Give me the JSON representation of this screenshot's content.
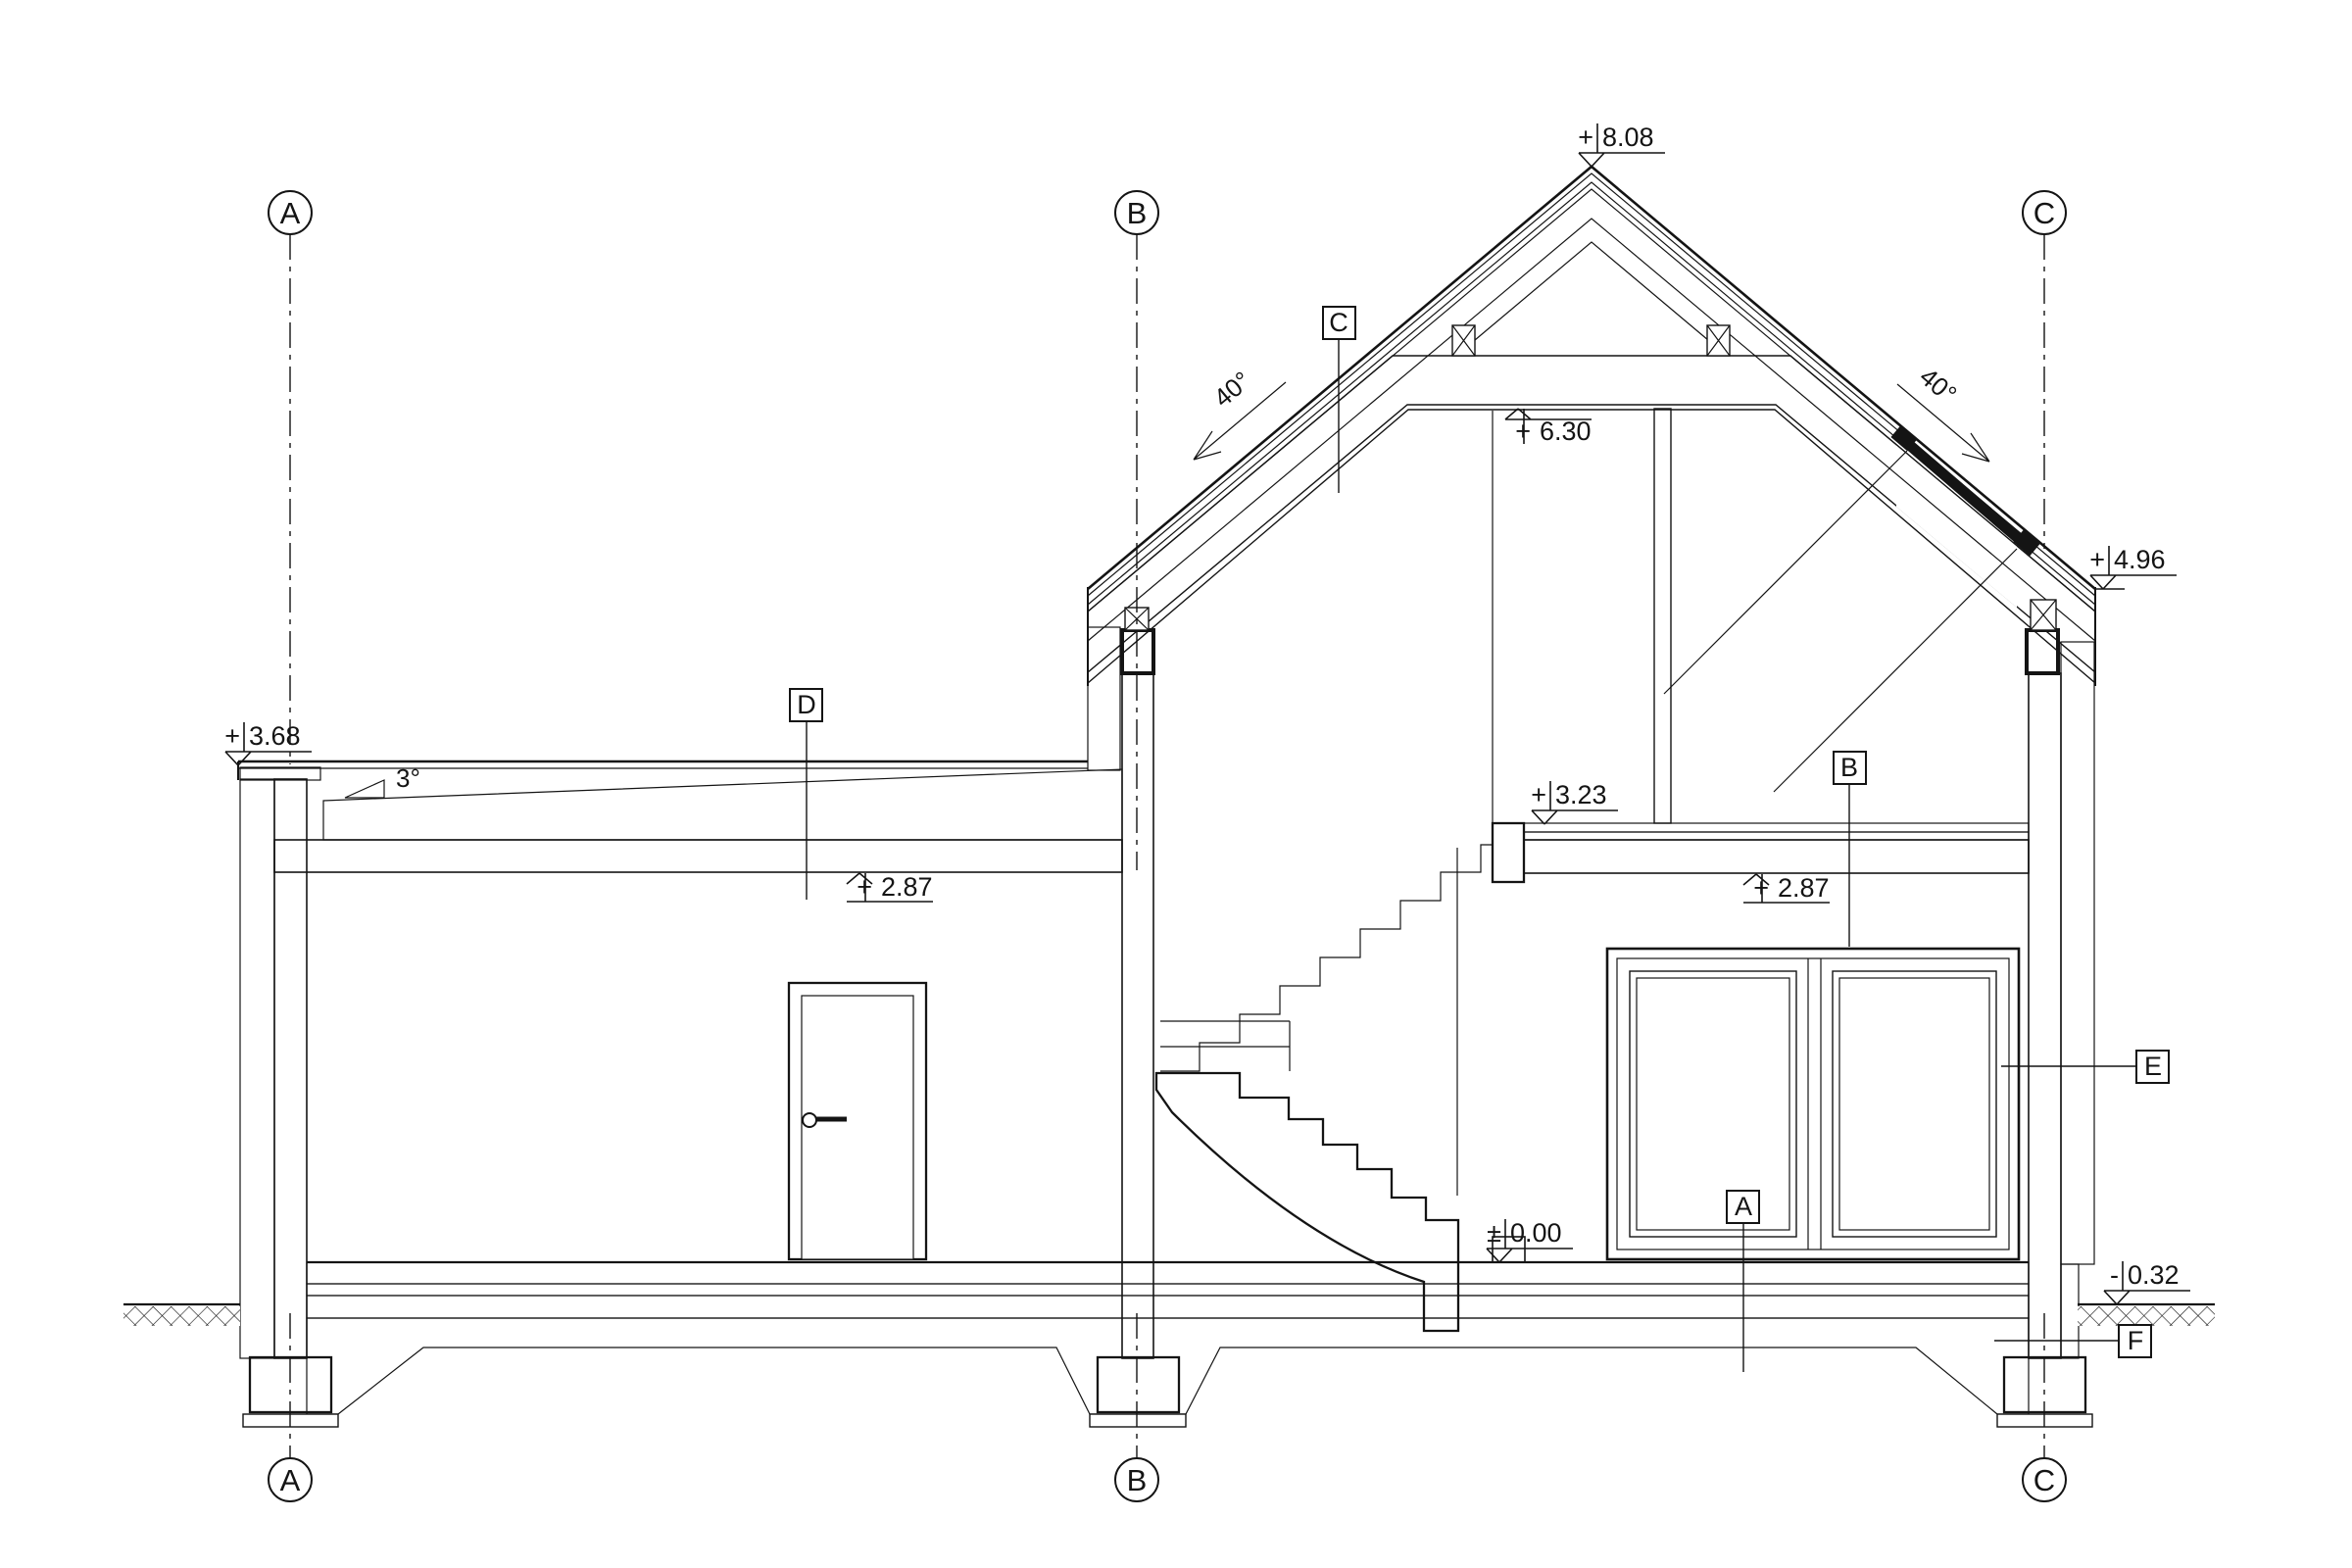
{
  "drawing": {
    "title": "building-cross-section",
    "grid": {
      "A": "A",
      "B": "B",
      "C": "C"
    },
    "levels": {
      "ridge": {
        "sign": "+",
        "value": "8.08"
      },
      "collar": {
        "sign": "+",
        "value": "6.30"
      },
      "right_eaves": {
        "sign": "+",
        "value": "4.96"
      },
      "annex_roof": {
        "sign": "+",
        "value": "3.68"
      },
      "attic_floor": {
        "sign": "+",
        "value": "3.23"
      },
      "annex_ceiling": {
        "sign": "+",
        "value": "2.87"
      },
      "main_ceiling": {
        "sign": "+",
        "value": "2.87"
      },
      "ground_floor": {
        "sign": "±",
        "value": "0.00"
      },
      "grade": {
        "sign": "-",
        "value": "0.32"
      }
    },
    "angles": {
      "left_roof": "40°",
      "right_roof": "40°",
      "annex_slope": "3°"
    },
    "tags": {
      "A": "A",
      "B": "B",
      "C": "C",
      "D": "D",
      "E": "E",
      "F": "F"
    }
  }
}
